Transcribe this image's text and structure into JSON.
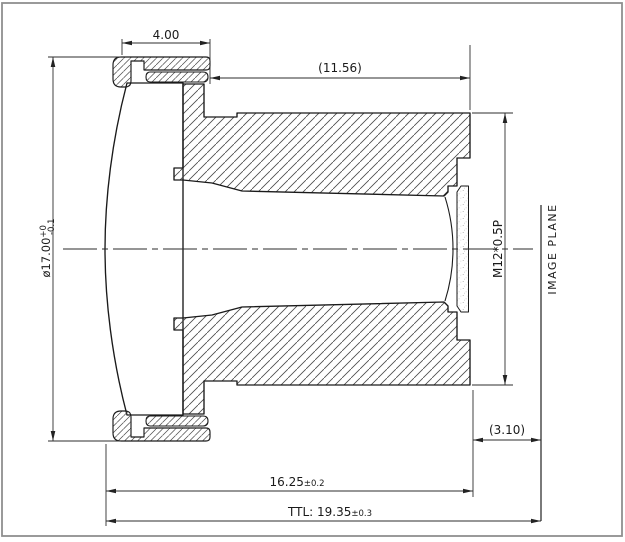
{
  "dimensions": {
    "ring_width": "4.00",
    "barrel_ref_length": "(11.56)",
    "lens_diameter": "ø17.00",
    "lens_diameter_tol_upper": "+0",
    "lens_diameter_tol_lower": "-0.1",
    "thread_spec": "M12*0.5P",
    "back_ref": "(3.10)",
    "mech_length": "16.25",
    "mech_length_tol": "±0.2",
    "ttl": "TTL: 19.35",
    "ttl_tol": "±0.3"
  },
  "labels": {
    "image_plane": "IMAGE PLANE"
  },
  "colors": {
    "outline": "#1a1a1a",
    "dimension_lines": "#2e2e2e",
    "hatch": "#4a4a4a",
    "background": "#ffffff",
    "frame": "#8f8f8f"
  }
}
